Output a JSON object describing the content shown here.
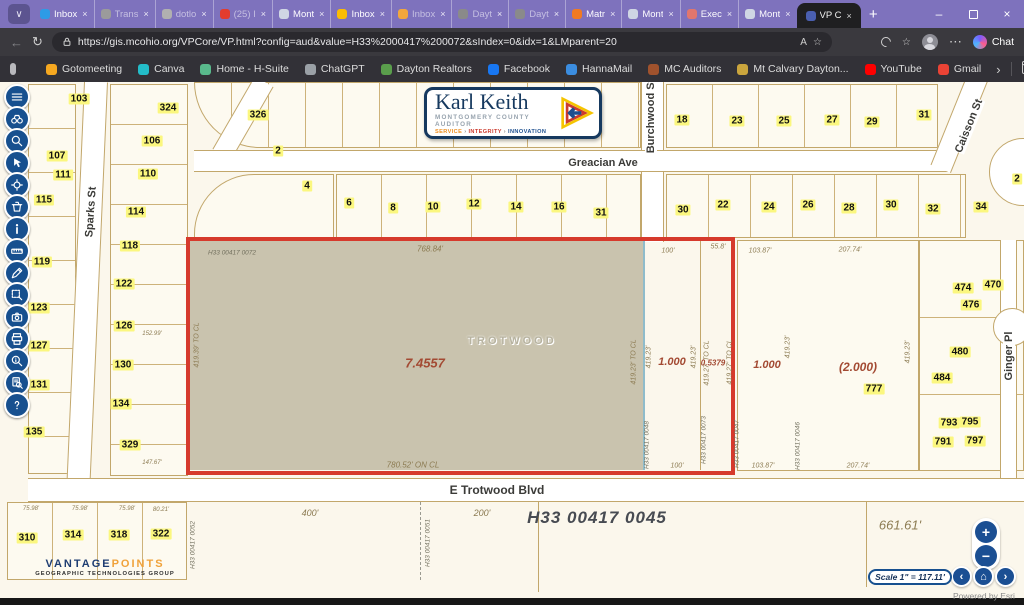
{
  "browser": {
    "tab_search_glyph": "∨",
    "new_tab": "+",
    "tabs": [
      {
        "label": "Inbox",
        "color": "#2e9be6",
        "muted": false,
        "active": false
      },
      {
        "label": "Trans",
        "color": "#9b9b9b",
        "muted": true,
        "active": false
      },
      {
        "label": "dotlo",
        "color": "#b0b0b0",
        "muted": true,
        "active": false
      },
      {
        "label": "(25) I",
        "color": "#e23c2e",
        "muted": true,
        "active": false
      },
      {
        "label": "Mont",
        "color": "#cfd6e4",
        "muted": false,
        "active": false
      },
      {
        "label": "Inbox",
        "color": "#fbbc05",
        "muted": false,
        "active": false
      },
      {
        "label": "Inbox",
        "color": "#f2a73d",
        "muted": true,
        "active": false
      },
      {
        "label": "Dayt",
        "color": "#8a8a8a",
        "muted": true,
        "active": false
      },
      {
        "label": "Dayt",
        "color": "#8a8a8a",
        "muted": true,
        "active": false
      },
      {
        "label": "Matr",
        "color": "#f07a22",
        "muted": false,
        "active": false
      },
      {
        "label": "Mont",
        "color": "#cfd6e4",
        "muted": false,
        "active": false
      },
      {
        "label": "Exec",
        "color": "#e0766d",
        "muted": false,
        "active": false
      },
      {
        "label": "Mont",
        "color": "#cfd6e4",
        "muted": false,
        "active": false
      },
      {
        "label": "VP C",
        "color": "#4a5fb0",
        "muted": false,
        "active": true
      }
    ],
    "close_glyph": "×",
    "window": {
      "minimize": "–",
      "close": "×"
    },
    "nav": {
      "back": "←",
      "refresh": "↻",
      "read_aloud": "A",
      "fav_star": "☆",
      "more": "⋯"
    },
    "url": "https://gis.mcohio.org/VPCore/VP.html?config=aud&value=H33%2000417%200072&sIndex=0&idx=1&LMparent=20",
    "chat_label": "Chat",
    "bookmarks": [
      {
        "label": "Gotomeeting",
        "color": "#f6a820"
      },
      {
        "label": "Canva",
        "color": "#23bcc8"
      },
      {
        "label": "Home - H-Suite",
        "color": "#59b98c"
      },
      {
        "label": "ChatGPT",
        "color": "#9aa0a6"
      },
      {
        "label": "Dayton Realtors",
        "color": "#5a9e4c"
      },
      {
        "label": "Facebook",
        "color": "#1877f2"
      },
      {
        "label": "HannaMail",
        "color": "#3b8de0"
      },
      {
        "label": "MC Auditors",
        "color": "#a0522d"
      },
      {
        "label": "Mt Calvary Dayton...",
        "color": "#caa53d"
      },
      {
        "label": "YouTube",
        "color": "#ff0000"
      },
      {
        "label": "Gmail",
        "color": "#ea4335"
      }
    ],
    "bm_overflow": "›",
    "other_favorites": "Other favorites"
  },
  "toolbar": {
    "buttons": [
      {
        "name": "menu"
      },
      {
        "name": "find-binoculars"
      },
      {
        "name": "zoom-search"
      },
      {
        "name": "pointer"
      },
      {
        "name": "locate"
      },
      {
        "name": "erase"
      },
      {
        "name": "info"
      },
      {
        "name": "measure"
      },
      {
        "name": "draw"
      },
      {
        "name": "select"
      },
      {
        "name": "screenshot"
      },
      {
        "name": "print"
      },
      {
        "name": "magnify-info"
      },
      {
        "name": "search-results"
      },
      {
        "name": "help"
      }
    ]
  },
  "logo": {
    "title": "Karl Keith",
    "subtitle": "MONTGOMERY COUNTY AUDITOR",
    "tagline": [
      "SERVICE",
      "INTEGRITY",
      "INNOVATION"
    ],
    "tagline_sep": "›"
  },
  "vantage": {
    "brand1": "VANTAGE",
    "brand2": "POINTS",
    "sub": "GEOGRAPHIC TECHNOLOGIES GROUP"
  },
  "esri": {
    "zoom_in": "+",
    "zoom_out": "−",
    "prev": "‹",
    "home": "⌂",
    "next": "›",
    "scale": "Scale 1\" = 117.11'",
    "powered": "Powered by Esri"
  },
  "map": {
    "selected_parcel": {
      "id": "H33 00417 0072",
      "acreage": "7.4557",
      "city": "TROTWOOD"
    },
    "labels": [
      {
        "t": "Sparks St",
        "x": 91,
        "y": 130,
        "r": -86,
        "c": "street"
      },
      {
        "t": "Greacian Ave",
        "x": 603,
        "y": 81,
        "r": 0,
        "c": "street"
      },
      {
        "t": "Burchwood St",
        "x": 651,
        "y": 34,
        "r": -90,
        "c": "street"
      },
      {
        "t": "Caisson St",
        "x": 969,
        "y": 44,
        "r": -68,
        "c": "street"
      },
      {
        "t": "Ginger Pl",
        "x": 1009,
        "y": 274,
        "r": -90,
        "c": "street"
      },
      {
        "t": "E Trotwood Blvd",
        "x": 497,
        "y": 408,
        "r": 0,
        "c": "street",
        "s": 12
      },
      {
        "t": "103",
        "x": 79,
        "y": 17,
        "c": "y"
      },
      {
        "t": "324",
        "x": 168,
        "y": 26,
        "c": "y"
      },
      {
        "t": "326",
        "x": 258,
        "y": 33,
        "c": "y"
      },
      {
        "t": "106",
        "x": 152,
        "y": 59,
        "c": "y"
      },
      {
        "t": "107",
        "x": 57,
        "y": 74,
        "c": "y"
      },
      {
        "t": "110",
        "x": 148,
        "y": 92,
        "c": "y"
      },
      {
        "t": "111",
        "x": 63,
        "y": 93,
        "c": "y"
      },
      {
        "t": "2",
        "x": 278,
        "y": 69,
        "c": "y"
      },
      {
        "t": "4",
        "x": 307,
        "y": 104,
        "c": "y"
      },
      {
        "t": "114",
        "x": 136,
        "y": 130,
        "c": "y"
      },
      {
        "t": "115",
        "x": 44,
        "y": 118,
        "c": "y"
      },
      {
        "t": "6",
        "x": 349,
        "y": 121,
        "c": "y"
      },
      {
        "t": "8",
        "x": 393,
        "y": 126,
        "c": "y"
      },
      {
        "t": "10",
        "x": 433,
        "y": 125,
        "c": "y"
      },
      {
        "t": "12",
        "x": 474,
        "y": 122,
        "c": "y"
      },
      {
        "t": "14",
        "x": 516,
        "y": 125,
        "c": "y"
      },
      {
        "t": "16",
        "x": 559,
        "y": 125,
        "c": "y"
      },
      {
        "t": "31",
        "x": 601,
        "y": 131,
        "c": "y"
      },
      {
        "t": "118",
        "x": 130,
        "y": 164,
        "c": "y"
      },
      {
        "t": "119",
        "x": 42,
        "y": 180,
        "c": "y"
      },
      {
        "t": "122",
        "x": 124,
        "y": 202,
        "c": "y"
      },
      {
        "t": "123",
        "x": 39,
        "y": 226,
        "c": "y"
      },
      {
        "t": "126",
        "x": 124,
        "y": 244,
        "c": "y"
      },
      {
        "t": "127",
        "x": 39,
        "y": 264,
        "c": "y"
      },
      {
        "t": "130",
        "x": 123,
        "y": 283,
        "c": "y"
      },
      {
        "t": "131",
        "x": 39,
        "y": 303,
        "c": "y"
      },
      {
        "t": "134",
        "x": 121,
        "y": 322,
        "c": "y"
      },
      {
        "t": "135",
        "x": 34,
        "y": 350,
        "c": "y"
      },
      {
        "t": "329",
        "x": 130,
        "y": 363,
        "c": "y"
      },
      {
        "t": "18",
        "x": 682,
        "y": 38,
        "c": "y"
      },
      {
        "t": "23",
        "x": 737,
        "y": 39,
        "c": "y"
      },
      {
        "t": "25",
        "x": 784,
        "y": 39,
        "c": "y"
      },
      {
        "t": "27",
        "x": 832,
        "y": 38,
        "c": "y"
      },
      {
        "t": "29",
        "x": 872,
        "y": 40,
        "c": "y"
      },
      {
        "t": "31",
        "x": 924,
        "y": 33,
        "c": "y"
      },
      {
        "t": "30",
        "x": 683,
        "y": 128,
        "c": "y"
      },
      {
        "t": "22",
        "x": 723,
        "y": 123,
        "c": "y"
      },
      {
        "t": "24",
        "x": 769,
        "y": 125,
        "c": "y"
      },
      {
        "t": "26",
        "x": 808,
        "y": 123,
        "c": "y"
      },
      {
        "t": "28",
        "x": 849,
        "y": 126,
        "c": "y"
      },
      {
        "t": "30",
        "x": 891,
        "y": 123,
        "c": "y"
      },
      {
        "t": "32",
        "x": 933,
        "y": 127,
        "c": "y"
      },
      {
        "t": "34",
        "x": 981,
        "y": 125,
        "c": "y"
      },
      {
        "t": "2",
        "x": 1017,
        "y": 97,
        "c": "y"
      },
      {
        "t": "474",
        "x": 963,
        "y": 206,
        "c": "y"
      },
      {
        "t": "470",
        "x": 993,
        "y": 203,
        "c": "y"
      },
      {
        "t": "476",
        "x": 971,
        "y": 223,
        "c": "y"
      },
      {
        "t": "480",
        "x": 960,
        "y": 270,
        "c": "y"
      },
      {
        "t": "484",
        "x": 942,
        "y": 296,
        "c": "y"
      },
      {
        "t": "777",
        "x": 874,
        "y": 307,
        "c": "y"
      },
      {
        "t": "793",
        "x": 949,
        "y": 341,
        "c": "y"
      },
      {
        "t": "795",
        "x": 970,
        "y": 340,
        "c": "y"
      },
      {
        "t": "791",
        "x": 943,
        "y": 360,
        "c": "y"
      },
      {
        "t": "797",
        "x": 975,
        "y": 359,
        "c": "y"
      },
      {
        "t": "310",
        "x": 27,
        "y": 456,
        "c": "y"
      },
      {
        "t": "314",
        "x": 73,
        "y": 453,
        "c": "y"
      },
      {
        "t": "318",
        "x": 119,
        "y": 453,
        "c": "y"
      },
      {
        "t": "322",
        "x": 161,
        "y": 452,
        "c": "y"
      },
      {
        "t": "768.84'",
        "x": 430,
        "y": 167,
        "c": "dim",
        "s": 8
      },
      {
        "t": "100'",
        "x": 668,
        "y": 169,
        "c": "dim"
      },
      {
        "t": "55.8'",
        "x": 718,
        "y": 165,
        "c": "dim"
      },
      {
        "t": "103.87'",
        "x": 760,
        "y": 169,
        "c": "dim"
      },
      {
        "t": "207.74'",
        "x": 850,
        "y": 168,
        "c": "dim"
      },
      {
        "t": "780.52' ON CL",
        "x": 413,
        "y": 383,
        "c": "dim",
        "s": 8
      },
      {
        "t": "100'",
        "x": 677,
        "y": 384,
        "c": "dim"
      },
      {
        "t": "103.87'",
        "x": 763,
        "y": 384,
        "c": "dim"
      },
      {
        "t": "207.74'",
        "x": 858,
        "y": 384,
        "c": "dim"
      },
      {
        "t": "419.39' TO CL",
        "x": 197,
        "y": 263,
        "r": -90,
        "c": "dim"
      },
      {
        "t": "419.23' TO CL",
        "x": 634,
        "y": 280,
        "r": -90,
        "c": "dim"
      },
      {
        "t": "419.23'",
        "x": 649,
        "y": 275,
        "r": -90,
        "c": "dim"
      },
      {
        "t": "419.23'",
        "x": 694,
        "y": 275,
        "r": -90,
        "c": "dim"
      },
      {
        "t": "419.27' TO CL",
        "x": 707,
        "y": 281,
        "r": -90,
        "c": "dim"
      },
      {
        "t": "419.27' TO CL",
        "x": 730,
        "y": 280,
        "r": -90,
        "c": "dim"
      },
      {
        "t": "419.23'",
        "x": 788,
        "y": 265,
        "r": -90,
        "c": "dim"
      },
      {
        "t": "419.23'",
        "x": 908,
        "y": 270,
        "r": -90,
        "c": "dim"
      },
      {
        "t": "152.99'",
        "x": 152,
        "y": 252,
        "c": "dim",
        "s": 6
      },
      {
        "t": "147.67'",
        "x": 152,
        "y": 381,
        "c": "dim",
        "s": 6
      },
      {
        "t": "75.98'",
        "x": 31,
        "y": 427,
        "c": "dim",
        "s": 6
      },
      {
        "t": "75.98'",
        "x": 80,
        "y": 427,
        "c": "dim",
        "s": 6
      },
      {
        "t": "75.98'",
        "x": 127,
        "y": 427,
        "c": "dim",
        "s": 6
      },
      {
        "t": "80.21'",
        "x": 161,
        "y": 428,
        "c": "dim",
        "s": 6
      },
      {
        "t": "400'",
        "x": 310,
        "y": 431,
        "c": "dim",
        "s": 9
      },
      {
        "t": "200'",
        "x": 482,
        "y": 431,
        "c": "dim",
        "s": 9
      },
      {
        "t": "661.61'",
        "x": 900,
        "y": 443,
        "c": "dim",
        "s": 13
      },
      {
        "t": "H33 00417 0072",
        "x": 232,
        "y": 171,
        "c": "id"
      },
      {
        "t": "H33 00417 0048",
        "x": 647,
        "y": 363,
        "r": -90,
        "c": "id"
      },
      {
        "t": "H33 00417 0073",
        "x": 704,
        "y": 358,
        "r": -90,
        "c": "id"
      },
      {
        "t": "H33 00417 0047",
        "x": 737,
        "y": 362,
        "r": -90,
        "c": "id"
      },
      {
        "t": "H33 00417 0046",
        "x": 798,
        "y": 364,
        "r": -90,
        "c": "id"
      },
      {
        "t": "H33 00417 0052",
        "x": 193,
        "y": 463,
        "r": -90,
        "c": "id"
      },
      {
        "t": "H33 00417 0051",
        "x": 428,
        "y": 461,
        "r": -90,
        "c": "id"
      },
      {
        "t": "H33 00417 0045",
        "x": 597,
        "y": 436,
        "c": "big"
      },
      {
        "t": "7.4557",
        "x": 425,
        "y": 281,
        "c": "acre",
        "s": 13
      },
      {
        "t": "1.000",
        "x": 672,
        "y": 280,
        "c": "acre"
      },
      {
        "t": "0.5379",
        "x": 713,
        "y": 281,
        "c": "acre",
        "s": 8
      },
      {
        "t": "1.000",
        "x": 767,
        "y": 283,
        "c": "acre"
      },
      {
        "t": "(2.000)",
        "x": 858,
        "y": 285,
        "c": "acre",
        "s": 12
      },
      {
        "t": "TROTWOOD",
        "x": 512,
        "y": 259,
        "c": "city"
      }
    ]
  }
}
